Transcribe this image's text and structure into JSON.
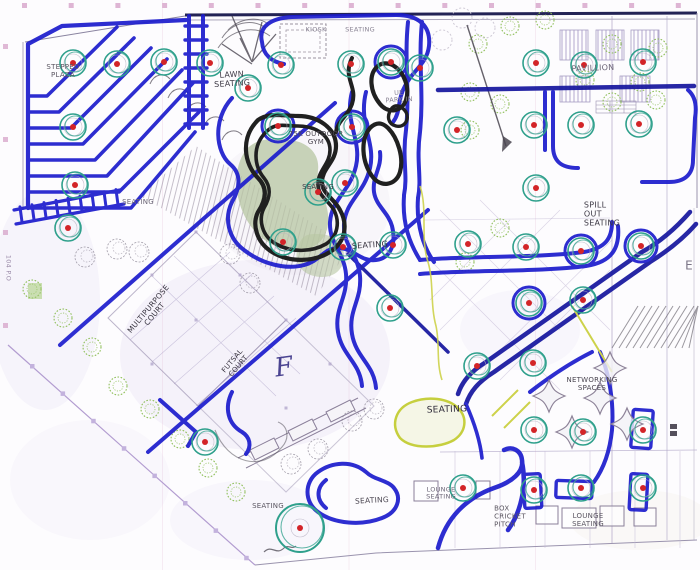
{
  "artwork": {
    "title": "Hand-drawn park masterplan concept sketch",
    "media": "Blue marker, black marker and pencil over a CAD base plan scan",
    "colors": {
      "marker_blue": "#1c1ccd",
      "marker_navy": "#15159e",
      "marker_black": "#202020",
      "tree_ring_teal": "#2fa08c",
      "tree_dot_red": "#d32428",
      "cad_line_purple": "#a79cc4",
      "cad_tree_green": "#8fbf5a",
      "grid_tick_pink": "#d8a8cc",
      "lawn_fill_green": "#b7c6a2",
      "highlight_yellow": "#cdd24a",
      "paper": "#fdfcfe"
    },
    "labels": {
      "stepped_plaza": "STEPPED\nPLAZA",
      "kiosk": "KIOSK",
      "seating_top": "SEATING",
      "lawn_seating": "LAWN\nSEATING",
      "outdoor_gym": "75K OUTDOOR\nGYM",
      "pavillion": "PAVILLION",
      "parking": "UE\nPARK IN",
      "seating_mound": "SEATING",
      "seating_center": "SEATING",
      "spill_out_seating": "SPILL\nOUT\nSEATING",
      "seating_left": "SEATING",
      "multipurpose_court": "MULTIPURPOSE\nCOURT",
      "futsal_court": "FUTSAL\nCOURT",
      "letter_f": "F",
      "letter_e": "E",
      "road_marker": "104 P.O",
      "networking_spaces": "NETWORKING\nSPACES",
      "seating_plaza_big": "SEATING",
      "seating_bottom_left": "SEATING",
      "seating_bottom_center": "SEATING",
      "lounge_seating_left": "LOUNGE\nSEATING",
      "box_cricket_pitch": "BOX\nCRICKET\nPITCH",
      "lounge_seating_right": "LOUNGE\nSEATING"
    }
  }
}
